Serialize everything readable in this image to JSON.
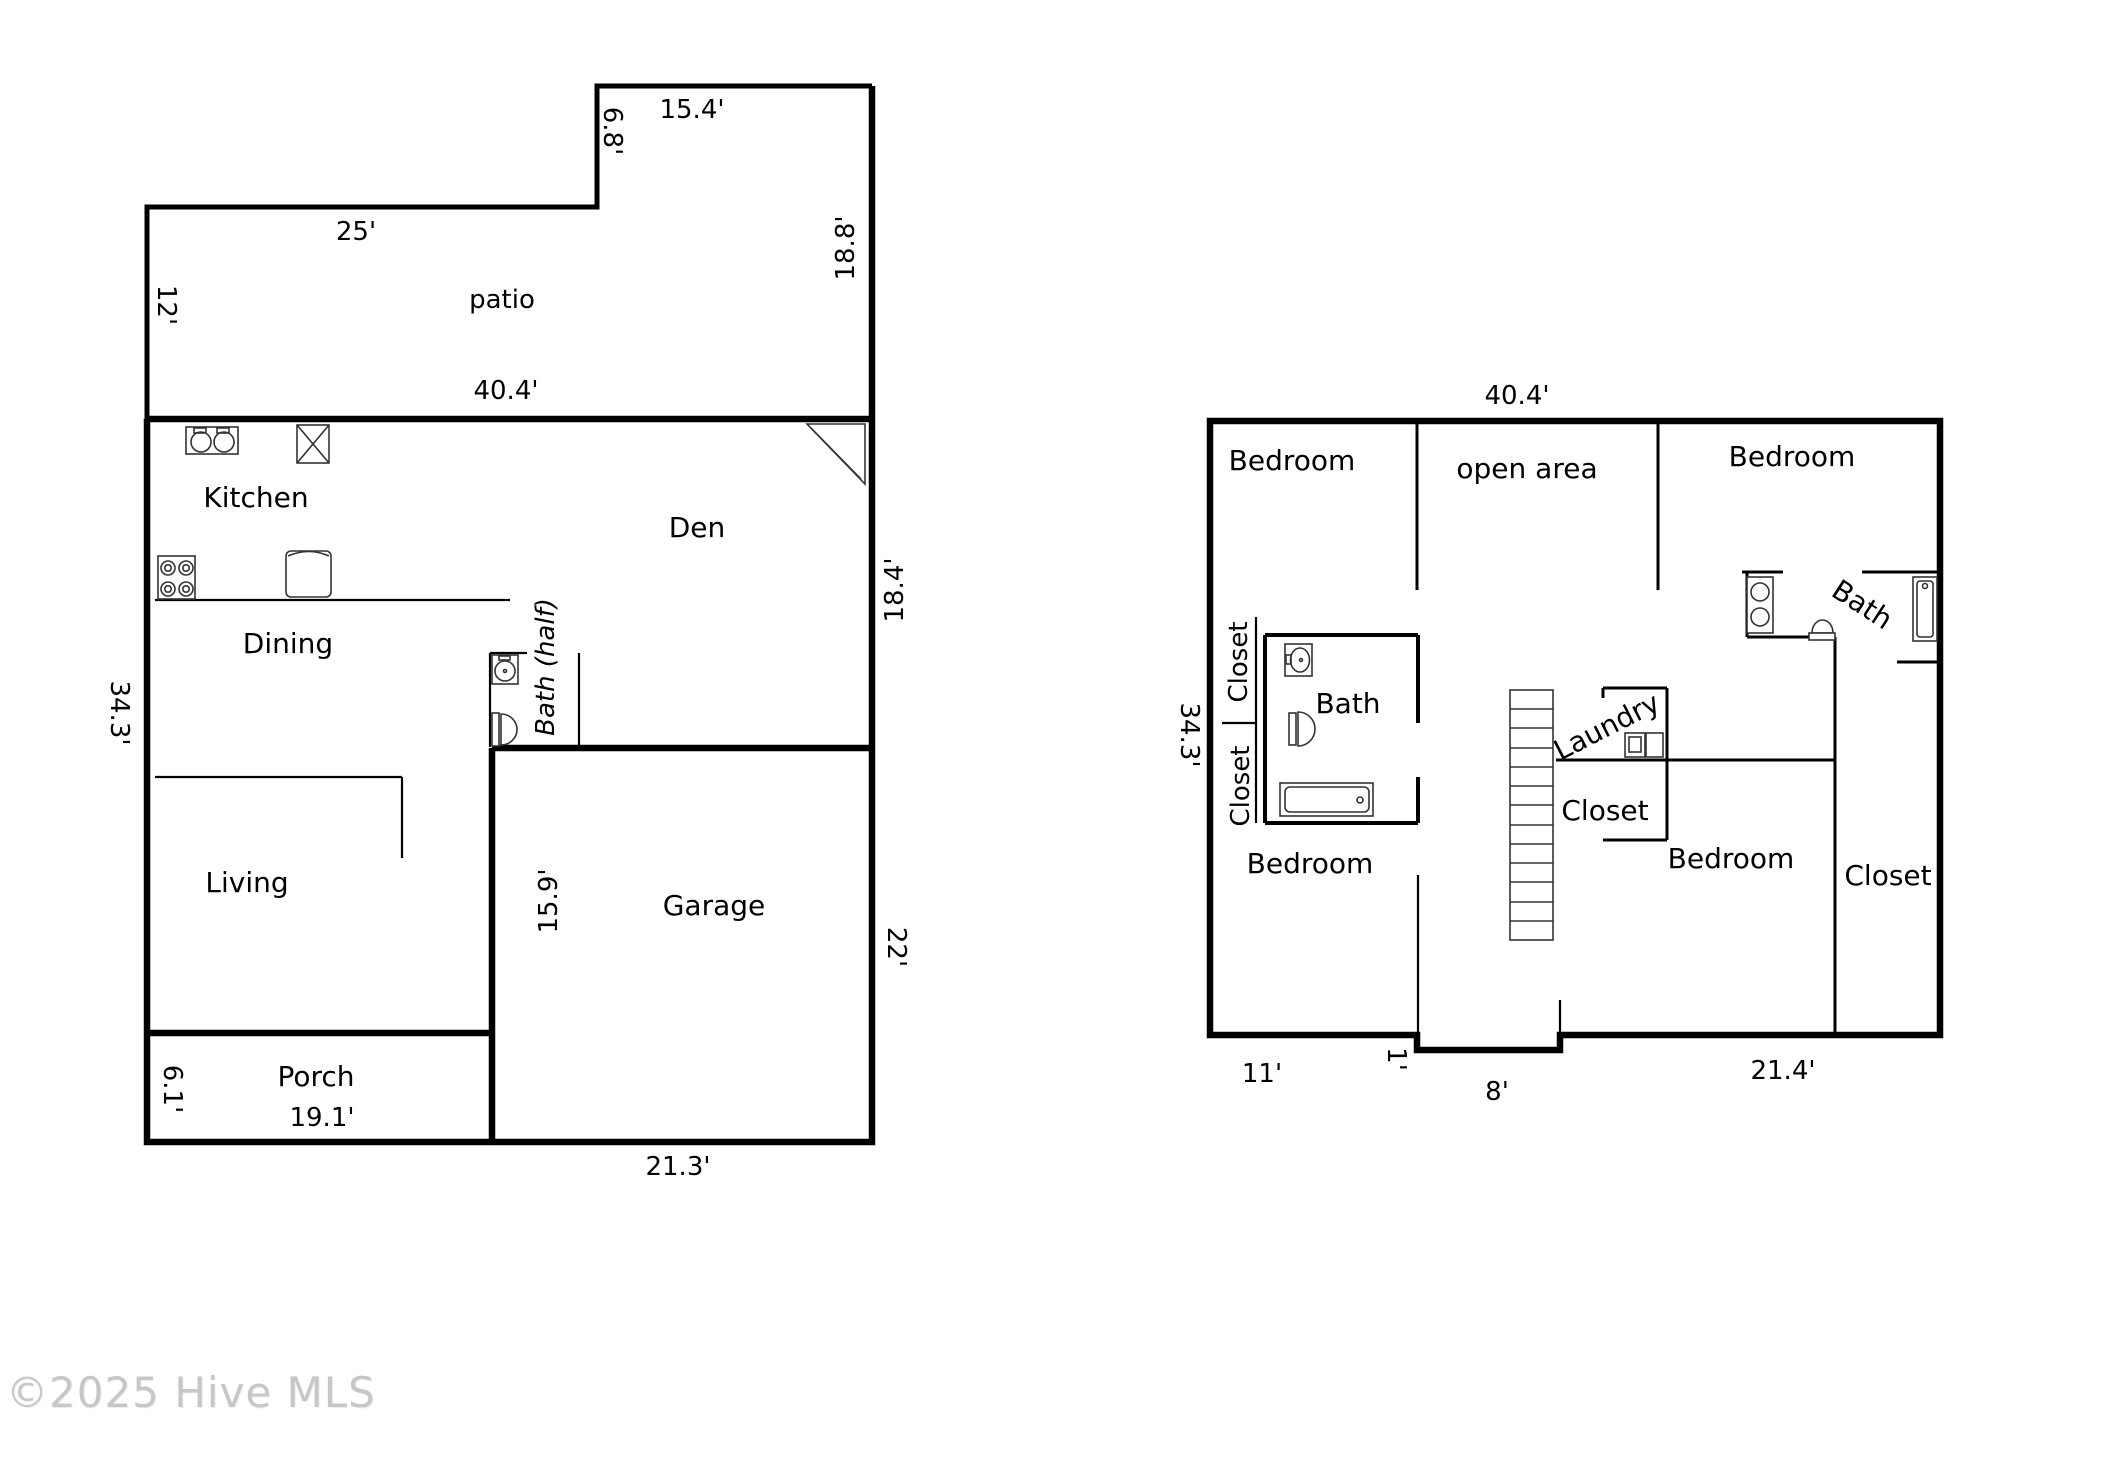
{
  "watermark": "©2025 Hive MLS",
  "floor1": {
    "rooms": {
      "patio": "patio",
      "kitchen": "Kitchen",
      "den": "Den",
      "dining": "Dining",
      "bath_half": "Bath (half)",
      "living": "Living",
      "garage": "Garage",
      "porch": "Porch"
    },
    "dims": {
      "top_right_width": "15.4'",
      "notch_height": "6.8'",
      "patio_top": "25'",
      "patio_left": "12'",
      "patio_right": "18.8'",
      "main_width": "40.4'",
      "den_right": "18.4'",
      "main_left": "34.3'",
      "garage_left": "15.9'",
      "garage_right": "22'",
      "porch_left": "6.1'",
      "porch_width": "19.1'",
      "garage_width": "21.3'"
    }
  },
  "floor2": {
    "rooms": {
      "bedroom_tl": "Bedroom",
      "open_area": "open area",
      "bedroom_tr": "Bedroom",
      "closet_up": "Closet",
      "closet_low": "Closet",
      "bath_left": "Bath",
      "laundry": "Laundry",
      "closet_mid": "Closet",
      "bedroom_bl": "Bedroom",
      "bedroom_br": "Bedroom",
      "closet_right": "Closet",
      "bath_right": "Bath"
    },
    "dims": {
      "top_width": "40.4'",
      "left_height": "34.3'",
      "bottom_left": "11'",
      "entry_depth": "1'",
      "entry_width": "8'",
      "bottom_right": "21.4'"
    }
  }
}
